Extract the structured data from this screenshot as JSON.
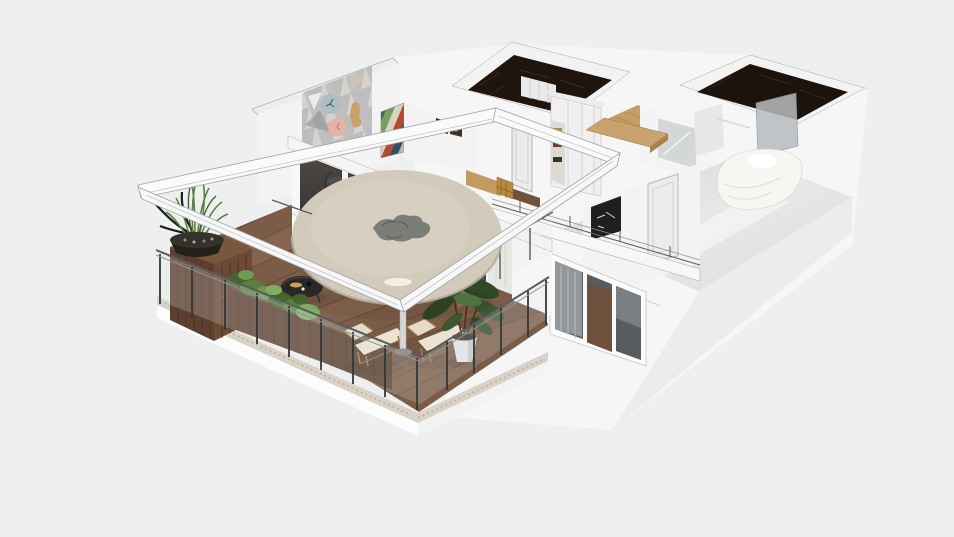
{
  "scene": {
    "description": "3D axonometric cutaway render of an apartment floor plan with a wraparound wooden-deck balcony, glass railings, white pergola frame, round outdoor table, lounge chairs, planters, dark marble bathroom walls, oak floors and a bedroom",
    "view": "axonometric-render",
    "background": "#eef0ef"
  },
  "palette": {
    "background": "#eef0ef",
    "wall_white": "#f6f6f7",
    "wall_light": "#f3f3f4",
    "wall_cap": "#ededee",
    "wall_shade": "#ececee",
    "beam_white": "#fafafa",
    "dark_marble": "#20150e",
    "dark_marble2": "#1d130d",
    "deck_wood": "#7b5c47",
    "deck_plank_line": "#5f4534",
    "stone_border": "#d9d2c6",
    "rustic_wood": "#5e4030",
    "rustic_wood_top": "#7a563d",
    "rustic_wood_side": "#6d4a34",
    "oak_floor": "#c49c66",
    "oak_canopy": "#c9a26d",
    "gloss_floor_a": "#d6d4d4",
    "gloss_floor_b": "#f0efee",
    "table_top": "#d2cabb",
    "table_shade": "#b6ae9e",
    "table_pedestal": "#e9e5dc",
    "centerpiece_gray": "#7b7d78",
    "cushion": "#ece4d0",
    "lounger_frame": "#a07c4c",
    "plant_green": "#4e7040",
    "plant_dark": "#2f4825",
    "hedge_green": "#5a8140",
    "grass_green": "#5d7f44",
    "glass_tint": "#dfe7e9",
    "rail_metal": "#32373a",
    "rail_top": "#575c5f",
    "window_glass": "#585c60",
    "window_wood_reflect": "#6e513c",
    "shower_glass": "#b7bcbe",
    "curtain": "#e9e7e3",
    "gold_accent": "#b9893c",
    "art_teal": "#2e6b5e",
    "art_red": "#b34a31",
    "art_green": "#74a061",
    "art_navy": "#2f4f6e",
    "mosaic_base": "#e8e8e8",
    "mosaic_tri": "#bdbdbd",
    "clock_blue": "#aebfc4",
    "clock_salmon": "#e4b3a4",
    "interior_dark": "#2b2724",
    "bed_white": "#f8f6f3",
    "pot_white": "#e6e6e4",
    "coffee_table": "#282828",
    "driftwood": "#1b1b1b",
    "door_panel": "#ececed",
    "mirror_glass": "#d3d7d8"
  },
  "objects": {
    "balcony": [
      "wood-deck",
      "glass-railing",
      "pergola-frame",
      "round-table",
      "plant-centerpiece",
      "lounge-chair-left",
      "lounge-chair-right",
      "potted-tree",
      "rustic-planter-cabinet",
      "grass-bowl-planter",
      "hedge-planter",
      "black-coffee-table",
      "white-step-shelf",
      "dried-branches"
    ],
    "interior": [
      "triangle-mosaic-wall",
      "wall-clock",
      "salmon-circle-decor",
      "chevron-artwork",
      "bar-stool",
      "sliding-glass-doors",
      "sheer-curtain",
      "gold-cabinet",
      "hall-door",
      "hall-wardrobe",
      "dark-marble-closet",
      "oak-corridor",
      "oak-canopy",
      "mirror-wardrobe",
      "dark-marble-bathroom",
      "shower-glass",
      "bedroom-door",
      "bedroom-art",
      "bed",
      "gloss-floor",
      "bedroom-parapet-rail",
      "three-pane-window"
    ]
  }
}
